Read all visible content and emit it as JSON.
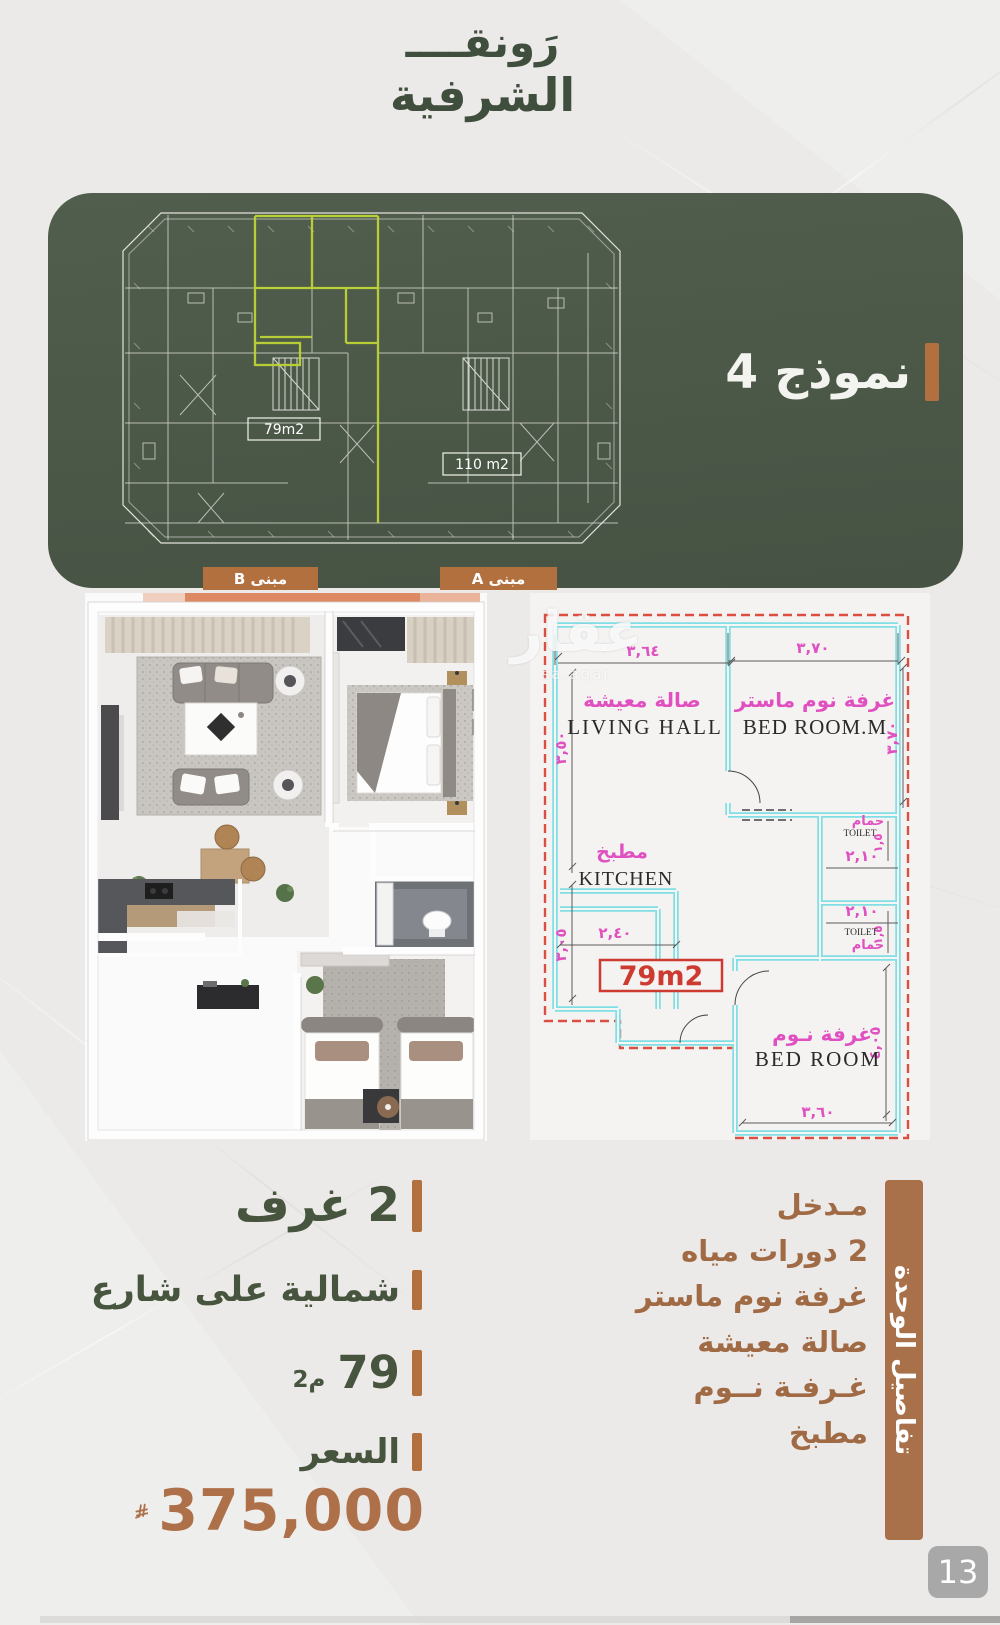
{
  "logo": {
    "line1": "رَونقــــ",
    "line2": "الشرفية"
  },
  "model": {
    "title": "نموذج 4"
  },
  "site_plan": {
    "building_b": "مبنى B",
    "building_a": "مبنى A",
    "area_b": "79m2",
    "area_a": "110 m2"
  },
  "plan2d": {
    "watermark_ar": "عقار",
    "watermark_en": "sa.aqar",
    "area_box": "79m2",
    "living_ar": "صالة معيشة",
    "living_en": "LIVING HALL",
    "master_ar": "غرفة نوم ماستر",
    "master_en": "BED ROOM.M",
    "kitchen_ar": "مطبخ",
    "kitchen_en": "KITCHEN",
    "toilet1_ar": "حمام",
    "toilet1_en": "TOILET",
    "toilet2_ar": "حمام",
    "toilet2_en": "TOILET",
    "bedroom_ar": "غرفة نـوم",
    "bedroom_en": "BED ROOM",
    "dims": {
      "top_left": "٣,٦٤",
      "top_right": "٣,٧٠",
      "right_upper": "٣,٧٠",
      "left_upper": "٣,٥٠",
      "left_lower": "٣,٠٥",
      "kitchen": "٢,٤٠",
      "toilet_w1": "٢,١٠",
      "toilet_w2": "٢,١٠",
      "toilet_s1": "١,٥",
      "toilet_s2": "١,٥",
      "bed_bottom": "٣,٦٠",
      "bed_right": "٤,٠٥"
    }
  },
  "specs": {
    "rooms": "2 غرف",
    "orientation": "شمالية على شارع",
    "area_value": "79",
    "area_unit": "م2",
    "price_label": "السعر",
    "price_value": "375,000"
  },
  "details": {
    "sidebar": "تفاصيل الوحدة",
    "items": [
      "مـدخل",
      "2 دورات مياه",
      "غرفة نوم ماستر",
      "صالة معيشة",
      "غـرفـة نــوم",
      "مطبخ"
    ]
  },
  "page_number": "13",
  "colors": {
    "panel_green": "#4b5747",
    "text_green": "#47553f",
    "accent_orange": "#b2703f",
    "list_brown": "#a06a45",
    "highlight": "#bdd435",
    "wall_cyan": "#7fdfe4",
    "label_pink": "#e050c0",
    "dash_red": "#da4f41"
  }
}
